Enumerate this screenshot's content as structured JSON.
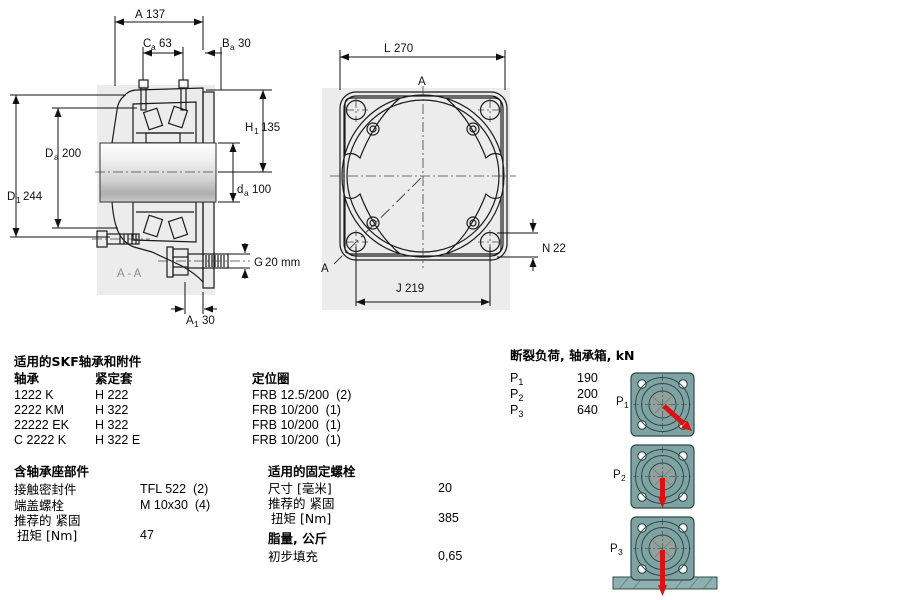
{
  "front_view": {
    "dim_A": {
      "label": "A",
      "value": "137"
    },
    "dim_Ca": {
      "label": "C",
      "sub": "a",
      "value": "63"
    },
    "dim_Ba": {
      "label": "B",
      "sub": "a",
      "value": "30"
    },
    "dim_H1": {
      "label": "H",
      "sub": "1",
      "value": "135"
    },
    "dim_Da": {
      "label": "D",
      "sub": "a",
      "value": "200"
    },
    "dim_da": {
      "label": "d",
      "sub": "a",
      "value": "100"
    },
    "dim_D1": {
      "label": "D",
      "sub": "1",
      "value": "244"
    },
    "dim_G": {
      "label": "G",
      "value": "20 mm"
    },
    "dim_A1": {
      "label": "A",
      "sub": "1",
      "value": "30"
    },
    "section_label": "A - A"
  },
  "flange_view": {
    "dim_L": {
      "label": "L",
      "value": "270"
    },
    "dim_J": {
      "label": "J",
      "value": "219"
    },
    "dim_N": {
      "label": "N",
      "value": "22"
    },
    "section_top": "A",
    "section_bottom": "A"
  },
  "bearings_table": {
    "title": "适用的SKF轴承和附件",
    "col_bearing": "轴承",
    "col_sleeve": "紧定套",
    "col_ring": "定位圈",
    "rows": [
      {
        "bearing": "1222 K",
        "sleeve": "H 222",
        "ring": "FRB 12.5/200  (2)"
      },
      {
        "bearing": "2222 KM",
        "sleeve": "H 322",
        "ring": "FRB 10/200  (1)"
      },
      {
        "bearing": "22222 EK",
        "sleeve": "H 322",
        "ring": "FRB 10/200  (1)"
      },
      {
        "bearing": "C 2222 K",
        "sleeve": "H 322 E",
        "ring": "FRB 10/200  (1)"
      }
    ]
  },
  "housing_parts": {
    "title": "含轴承座部件",
    "rows": [
      {
        "label": "接触密封件",
        "value": "TFL 522  (2)"
      },
      {
        "label": "端盖螺栓",
        "value": "M 10x30  (4)"
      },
      {
        "label": "推荐的 紧固",
        "value": ""
      },
      {
        "label": "扭矩 [Nm]",
        "value": "47"
      }
    ]
  },
  "fixing_bolts": {
    "title": "适用的固定螺栓",
    "rows": [
      {
        "label": "尺寸 [毫米]",
        "value": "20"
      },
      {
        "label": "推荐的 紧固",
        "value": ""
      },
      {
        "label": "扭矩 [Nm]",
        "value": "385"
      }
    ]
  },
  "grease": {
    "title": "脂量, 公斤",
    "rows": [
      {
        "label": "初步填充",
        "value": "0,65"
      }
    ]
  },
  "breaking_loads": {
    "title": "断裂负荷, 轴承箱, kN",
    "rows": [
      {
        "label": "P",
        "sub": "1",
        "value": "190"
      },
      {
        "label": "P",
        "sub": "2",
        "value": "200"
      },
      {
        "label": "P",
        "sub": "3",
        "value": "640"
      }
    ]
  },
  "colors": {
    "housing_blue": "#b7cde5",
    "flange_teal": "#7fa3a3",
    "arrow_red": "#dd1111",
    "watermark_gray": "#ececec"
  }
}
